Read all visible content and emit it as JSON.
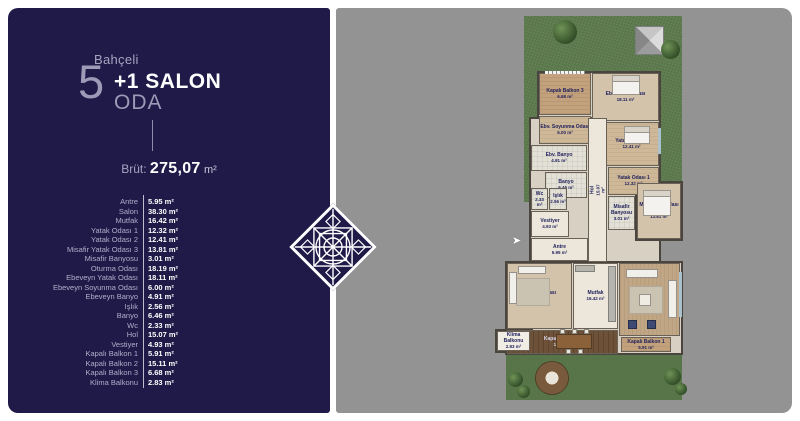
{
  "sidebar": {
    "project_label": "Bahçeli",
    "rooms_count": "5",
    "salon_label": "+1 SALON",
    "oda_label": "ODA",
    "brut_label": "Brüt:",
    "brut_value": "275,07",
    "brut_unit": "m²",
    "room_list": [
      {
        "name": "Antre",
        "area": "5.95 m²"
      },
      {
        "name": "Salon",
        "area": "38.30 m²"
      },
      {
        "name": "Mutfak",
        "area": "16.42 m²"
      },
      {
        "name": "Yatak Odası 1",
        "area": "12.32 m²"
      },
      {
        "name": "Yatak Odası 2",
        "area": "12.41 m²"
      },
      {
        "name": "Misafir Yatak Odası 3",
        "area": "13.81 m²"
      },
      {
        "name": "Misafir Banyosu",
        "area": "3.01 m²"
      },
      {
        "name": "Oturma Odası",
        "area": "18.19 m²"
      },
      {
        "name": "Ebeveyn Yatak Odası",
        "area": "18.11 m²"
      },
      {
        "name": "Ebeveyn Soyunma Odası",
        "area": "6.00 m²"
      },
      {
        "name": "Ebeveyn Banyo",
        "area": "4.91 m²"
      },
      {
        "name": "Işlık",
        "area": "2.56 m²"
      },
      {
        "name": "Banyo",
        "area": "6.46 m²"
      },
      {
        "name": "Wc",
        "area": "2.33 m²"
      },
      {
        "name": "Hol",
        "area": "15.07 m²"
      },
      {
        "name": "Vestiyer",
        "area": "4.93 m²"
      },
      {
        "name": "Kapalı Balkon 1",
        "area": "5.91 m²"
      },
      {
        "name": "Kapalı Balkon 2",
        "area": "15.11 m²"
      },
      {
        "name": "Kapalı Balkon 3",
        "area": "6.68 m²"
      },
      {
        "name": "Klima Balkonu",
        "area": "2.83 m²"
      }
    ]
  },
  "plan": {
    "entry_arrow": "➤",
    "rooms": [
      {
        "label": "Kapalı Balkon 3",
        "area": "6.68 m²"
      },
      {
        "label": "Ebv. Yatak Odası",
        "area": "18.11 m²"
      },
      {
        "label": "Ebv. Soyunma Odası",
        "area": "6.00 m²"
      },
      {
        "label": "Yatak Odası 2",
        "area": "12.41 m²"
      },
      {
        "label": "Ebv. Banyo",
        "area": "4.91 m²"
      },
      {
        "label": "Banyo",
        "area": "6.46 m²"
      },
      {
        "label": "Yatak Odası 1",
        "area": "12.32 m²"
      },
      {
        "label": "Misafir Banyosu",
        "area": "3.01 m²"
      },
      {
        "label": "Mis. Yatak Odası 3",
        "area": "13.81 m²"
      },
      {
        "label": "Wc",
        "area": "2.33 m²"
      },
      {
        "label": "Işlık",
        "area": "2.56 m²"
      },
      {
        "label": "Vestiyer",
        "area": "4.93 m²"
      },
      {
        "label": "Hol",
        "area": "15.07 m²"
      },
      {
        "label": "Antre",
        "area": "5.95 m²"
      },
      {
        "label": "Oturma Odası",
        "area": "18.19 m²"
      },
      {
        "label": "Mutfak",
        "area": "16.42 m²"
      },
      {
        "label": "Salon",
        "area": "38.30 m²"
      },
      {
        "label": "Kapalı Balkon 2",
        "area": "15.11 m²"
      },
      {
        "label": "Kapalı Balkon 1",
        "area": "5.91 m²"
      },
      {
        "label": "Klima Balkonu",
        "area": "2.83 m²"
      }
    ]
  },
  "colors": {
    "navy": "#201a49",
    "gray_bg": "#939393",
    "lawn_green": "#5d7b4e",
    "label_navy": "#23235e",
    "text_lavender": "#b2aec9",
    "wood_dark": "#6d5138"
  }
}
